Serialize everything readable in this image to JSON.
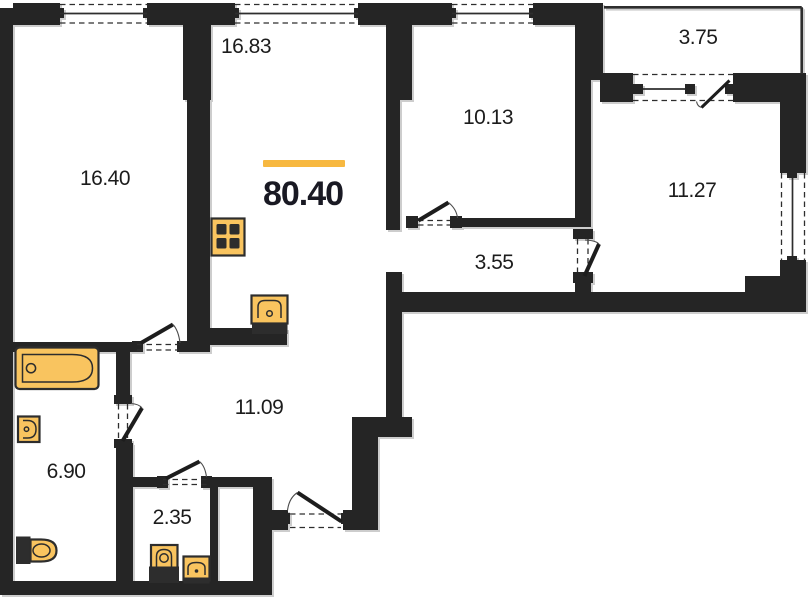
{
  "floorplan": {
    "total_area": "80.40",
    "rooms": [
      {
        "name": "living-kitchen",
        "area": "16.83"
      },
      {
        "name": "bedroom-left",
        "area": "16.40"
      },
      {
        "name": "bedroom-middle",
        "area": "10.13"
      },
      {
        "name": "balcony",
        "area": "3.75"
      },
      {
        "name": "bedroom-right",
        "area": "11.27"
      },
      {
        "name": "inner-corridor",
        "area": "3.55"
      },
      {
        "name": "hallway",
        "area": "11.09"
      },
      {
        "name": "bathroom",
        "area": "6.90"
      },
      {
        "name": "wc",
        "area": "2.35"
      }
    ],
    "fixtures": [
      "bathtub-icon",
      "washbasin-icon",
      "toilet-icon",
      "stove-icon",
      "kitchen-sink-icon",
      "wc-toilet-icon",
      "wc-washbasin-icon"
    ],
    "colors": {
      "wall": "#252525",
      "fixture_fill": "#F9C45F",
      "fixture_outline": "#2d2d2d",
      "accent": "#F7B840",
      "label_text": "#1c1c1c",
      "total_text": "#191923"
    }
  }
}
